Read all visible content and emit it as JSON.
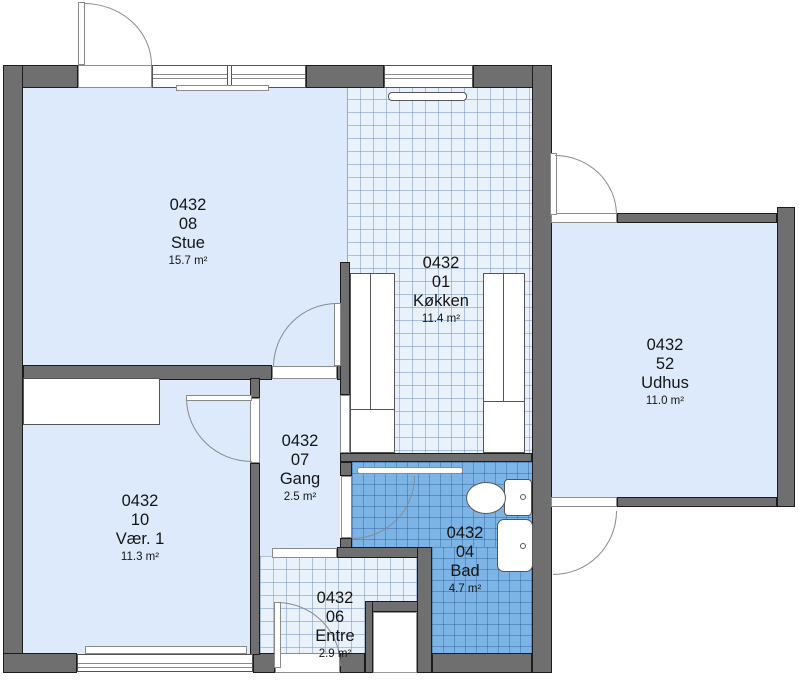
{
  "plan": {
    "title": "Floor plan",
    "rooms": [
      {
        "code": "0432",
        "number": "08",
        "name": "Stue",
        "area": "15.7 m²"
      },
      {
        "code": "0432",
        "number": "01",
        "name": "Køkken",
        "area": "11.4 m²"
      },
      {
        "code": "0432",
        "number": "52",
        "name": "Udhus",
        "area": "11.0 m²"
      },
      {
        "code": "0432",
        "number": "07",
        "name": "Gang",
        "area": "2.5 m²"
      },
      {
        "code": "0432",
        "number": "10",
        "name": "Vær. 1",
        "area": "11.3 m²"
      },
      {
        "code": "0432",
        "number": "04",
        "name": "Bad",
        "area": "4.7 m²"
      },
      {
        "code": "0432",
        "number": "06",
        "name": "Entre",
        "area": "2.9 m²"
      }
    ],
    "colors": {
      "wall": "#6f6f6f",
      "wall_edge": "#1c1c1c",
      "floor": "#dceafc",
      "tile_light": "#e9f1fb",
      "tile_blue": "#7db4e6",
      "door_line": "#8a8a8a",
      "fixture_edge": "#555555",
      "text": "#151515"
    }
  }
}
